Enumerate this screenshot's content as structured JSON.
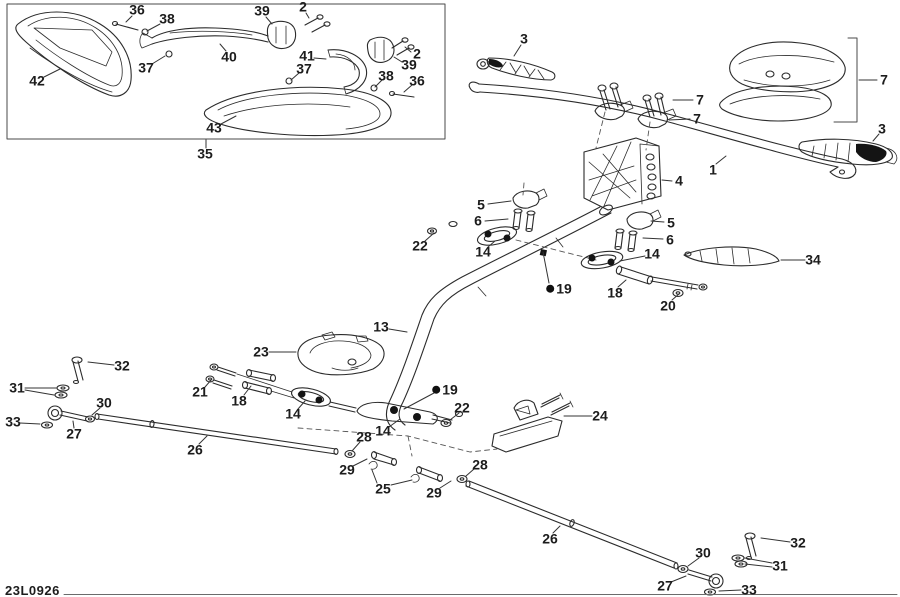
{
  "diagram": {
    "code": "23L0926",
    "ink_color": "#2b2b2b",
    "label_color": "#1c1c1c",
    "labels": [
      {
        "t": "36",
        "x": 137,
        "y": 10,
        "l": [
          [
            [
              132,
              16
            ],
            [
              126,
              22
            ]
          ]
        ]
      },
      {
        "t": "38",
        "x": 167,
        "y": 19,
        "l": [
          [
            [
              160,
              24
            ],
            [
              147,
              31
            ]
          ]
        ]
      },
      {
        "t": "39",
        "x": 262,
        "y": 11,
        "l": [
          [
            [
              266,
              17
            ],
            [
              272,
              24
            ]
          ]
        ]
      },
      {
        "t": "2",
        "x": 303,
        "y": 7,
        "l": [
          [
            [
              306,
              13
            ],
            [
              309,
              18
            ]
          ]
        ]
      },
      {
        "t": "40",
        "x": 229,
        "y": 57,
        "l": [
          [
            [
              226,
              51
            ],
            [
              220,
              44
            ]
          ]
        ]
      },
      {
        "t": "41",
        "x": 307,
        "y": 56,
        "l": [
          [
            [
              314,
              58
            ],
            [
              326,
              59
            ]
          ]
        ]
      },
      {
        "t": "2",
        "x": 417,
        "y": 54,
        "l": [
          [
            [
              411,
              52
            ],
            [
              405,
              47
            ]
          ]
        ]
      },
      {
        "t": "39",
        "x": 409,
        "y": 65,
        "l": [
          [
            [
              402,
              62
            ],
            [
              394,
              57
            ]
          ]
        ]
      },
      {
        "t": "37",
        "x": 146,
        "y": 68,
        "l": [
          [
            [
              152,
              64
            ],
            [
              165,
              56
            ]
          ]
        ]
      },
      {
        "t": "37",
        "x": 304,
        "y": 69,
        "l": [
          [
            [
              299,
              73
            ],
            [
              291,
              80
            ]
          ]
        ]
      },
      {
        "t": "38",
        "x": 386,
        "y": 76,
        "l": [
          [
            [
              382,
              80
            ],
            [
              375,
              87
            ]
          ]
        ]
      },
      {
        "t": "36",
        "x": 417,
        "y": 81,
        "l": [
          [
            [
              412,
              85
            ],
            [
              404,
              92
            ]
          ]
        ]
      },
      {
        "t": "42",
        "x": 37,
        "y": 81,
        "l": [
          [
            [
              44,
              77
            ],
            [
              60,
              69
            ]
          ]
        ]
      },
      {
        "t": "43",
        "x": 214,
        "y": 128,
        "l": [
          [
            [
              221,
              124
            ],
            [
              236,
              116
            ]
          ]
        ]
      },
      {
        "t": "35",
        "x": 205,
        "y": 154,
        "l": [
          [
            [
              206,
              148
            ],
            [
              206,
              140
            ]
          ]
        ]
      },
      {
        "t": "3",
        "x": 524,
        "y": 39,
        "l": [
          [
            [
              521,
              45
            ],
            [
              514,
              56
            ]
          ]
        ]
      },
      {
        "t": "7",
        "x": 884,
        "y": 80,
        "l": [
          [
            [
              877,
              80
            ],
            [
              859,
              80
            ]
          ]
        ]
      },
      {
        "t": "7",
        "x": 700,
        "y": 100,
        "l": [
          [
            [
              693,
              100
            ],
            [
              673,
              100
            ]
          ]
        ]
      },
      {
        "t": "7",
        "x": 697,
        "y": 119,
        "l": [
          [
            [
              690,
              119
            ],
            [
              669,
              120
            ]
          ]
        ]
      },
      {
        "t": "3",
        "x": 882,
        "y": 129,
        "l": [
          [
            [
              879,
              134
            ],
            [
              873,
              141
            ]
          ]
        ]
      },
      {
        "t": "1",
        "x": 713,
        "y": 170,
        "l": [
          [
            [
              716,
              164
            ],
            [
              726,
              156
            ]
          ]
        ]
      },
      {
        "t": "4",
        "x": 679,
        "y": 181,
        "l": [
          [
            [
              672,
              181
            ],
            [
              662,
              180
            ]
          ]
        ]
      },
      {
        "t": "5",
        "x": 481,
        "y": 205,
        "l": [
          [
            [
              488,
              204
            ],
            [
              511,
              201
            ]
          ]
        ]
      },
      {
        "t": "6",
        "x": 478,
        "y": 221,
        "l": [
          [
            [
              485,
              221
            ],
            [
              508,
              219
            ]
          ]
        ]
      },
      {
        "t": "22",
        "x": 420,
        "y": 246,
        "l": [
          [
            [
              425,
              241
            ],
            [
              434,
              233
            ]
          ]
        ]
      },
      {
        "t": "14",
        "x": 483,
        "y": 252,
        "l": [
          [
            [
              488,
              247
            ],
            [
              495,
              241
            ]
          ]
        ]
      },
      {
        "t": "5",
        "x": 671,
        "y": 223,
        "l": [
          [
            [
              664,
              222
            ],
            [
              651,
              221
            ]
          ]
        ]
      },
      {
        "t": "6",
        "x": 670,
        "y": 240,
        "l": [
          [
            [
              663,
              239
            ],
            [
              643,
              238
            ]
          ]
        ]
      },
      {
        "t": "14",
        "x": 652,
        "y": 254,
        "l": [
          [
            [
              645,
              256
            ],
            [
              620,
              261
            ]
          ]
        ]
      },
      {
        "t": "34",
        "x": 813,
        "y": 260,
        "l": [
          [
            [
              805,
              260
            ],
            [
              781,
              260
            ]
          ]
        ]
      },
      {
        "t": "19",
        "x": 559,
        "y": 289,
        "g": 1,
        "l": [
          [
            [
              549,
              283
            ],
            [
              543,
              252
            ]
          ]
        ]
      },
      {
        "t": "18",
        "x": 615,
        "y": 293,
        "l": [
          [
            [
              618,
              287
            ],
            [
              626,
              280
            ]
          ]
        ]
      },
      {
        "t": "20",
        "x": 668,
        "y": 306,
        "l": [
          [
            [
              672,
              300
            ],
            [
              679,
              294
            ]
          ]
        ]
      },
      {
        "t": "13",
        "x": 381,
        "y": 327,
        "l": [
          [
            [
              389,
              329
            ],
            [
              407,
              332
            ]
          ]
        ]
      },
      {
        "t": "23",
        "x": 261,
        "y": 352,
        "l": [
          [
            [
              269,
              352
            ],
            [
              296,
              352
            ]
          ]
        ]
      },
      {
        "t": "32",
        "x": 122,
        "y": 366,
        "l": [
          [
            [
              114,
              365
            ],
            [
              88,
              362
            ]
          ]
        ]
      },
      {
        "t": "31",
        "x": 17,
        "y": 388,
        "l": [
          [
            [
              25,
              388
            ],
            [
              56,
              388
            ]
          ],
          [
            [
              25,
              390
            ],
            [
              54,
              395
            ]
          ]
        ]
      },
      {
        "t": "30",
        "x": 104,
        "y": 403,
        "l": [
          [
            [
              100,
              408
            ],
            [
              92,
              415
            ]
          ]
        ]
      },
      {
        "t": "33",
        "x": 13,
        "y": 422,
        "l": [
          [
            [
              20,
              423
            ],
            [
              40,
              424
            ]
          ]
        ]
      },
      {
        "t": "27",
        "x": 74,
        "y": 434,
        "l": [
          [
            [
              74,
              428
            ],
            [
              73,
              421
            ]
          ]
        ]
      },
      {
        "t": "26",
        "x": 195,
        "y": 450,
        "l": [
          [
            [
              199,
              444
            ],
            [
              207,
              436
            ]
          ]
        ]
      },
      {
        "t": "21",
        "x": 200,
        "y": 392,
        "l": [
          [
            [
              205,
              387
            ],
            [
              212,
              379
            ]
          ]
        ]
      },
      {
        "t": "18",
        "x": 239,
        "y": 401,
        "l": [
          [
            [
              244,
              395
            ],
            [
              251,
              386
            ]
          ]
        ]
      },
      {
        "t": "14",
        "x": 293,
        "y": 414,
        "l": [
          [
            [
              298,
              409
            ],
            [
              305,
              401
            ]
          ]
        ]
      },
      {
        "t": "19",
        "x": 445,
        "y": 390,
        "g": 1,
        "l": [
          [
            [
              434,
              393
            ],
            [
              404,
              409
            ]
          ]
        ]
      },
      {
        "t": "22",
        "x": 462,
        "y": 408,
        "l": [
          [
            [
              459,
              413
            ],
            [
              450,
              420
            ]
          ]
        ]
      },
      {
        "t": "24",
        "x": 600,
        "y": 416,
        "l": [
          [
            [
              592,
              416
            ],
            [
              564,
              416
            ]
          ]
        ]
      },
      {
        "t": "28",
        "x": 364,
        "y": 437,
        "l": [
          [
            [
              360,
              442
            ],
            [
              352,
              451
            ]
          ]
        ]
      },
      {
        "t": "14",
        "x": 383,
        "y": 431,
        "l": [
          [
            [
              389,
              427
            ],
            [
              400,
              419
            ]
          ]
        ]
      },
      {
        "t": "29",
        "x": 347,
        "y": 470,
        "l": [
          [
            [
              353,
              466
            ],
            [
              367,
              459
            ]
          ]
        ]
      },
      {
        "t": "25",
        "x": 383,
        "y": 489,
        "l": [
          [
            [
              377,
              483
            ],
            [
              372,
              470
            ]
          ],
          [
            [
              391,
              485
            ],
            [
              412,
              480
            ]
          ]
        ]
      },
      {
        "t": "29",
        "x": 434,
        "y": 493,
        "l": [
          [
            [
              440,
              488
            ],
            [
              451,
              481
            ]
          ]
        ]
      },
      {
        "t": "28",
        "x": 480,
        "y": 465,
        "l": [
          [
            [
              474,
              469
            ],
            [
              466,
              476
            ]
          ]
        ]
      },
      {
        "t": "26",
        "x": 550,
        "y": 539,
        "l": [
          [
            [
              553,
              533
            ],
            [
              560,
              526
            ]
          ]
        ]
      },
      {
        "t": "30",
        "x": 703,
        "y": 553,
        "l": [
          [
            [
              699,
              558
            ],
            [
              688,
              566
            ]
          ]
        ]
      },
      {
        "t": "32",
        "x": 798,
        "y": 543,
        "l": [
          [
            [
              790,
              542
            ],
            [
              761,
              538
            ]
          ]
        ]
      },
      {
        "t": "31",
        "x": 780,
        "y": 566,
        "l": [
          [
            [
              772,
              563
            ],
            [
              745,
              558
            ]
          ],
          [
            [
              772,
              567
            ],
            [
              745,
              564
            ]
          ]
        ]
      },
      {
        "t": "27",
        "x": 665,
        "y": 586,
        "l": [
          [
            [
              671,
              582
            ],
            [
              686,
              576
            ]
          ]
        ]
      },
      {
        "t": "33",
        "x": 749,
        "y": 590,
        "l": [
          [
            [
              741,
              590
            ],
            [
              719,
              591
            ]
          ]
        ]
      }
    ]
  }
}
